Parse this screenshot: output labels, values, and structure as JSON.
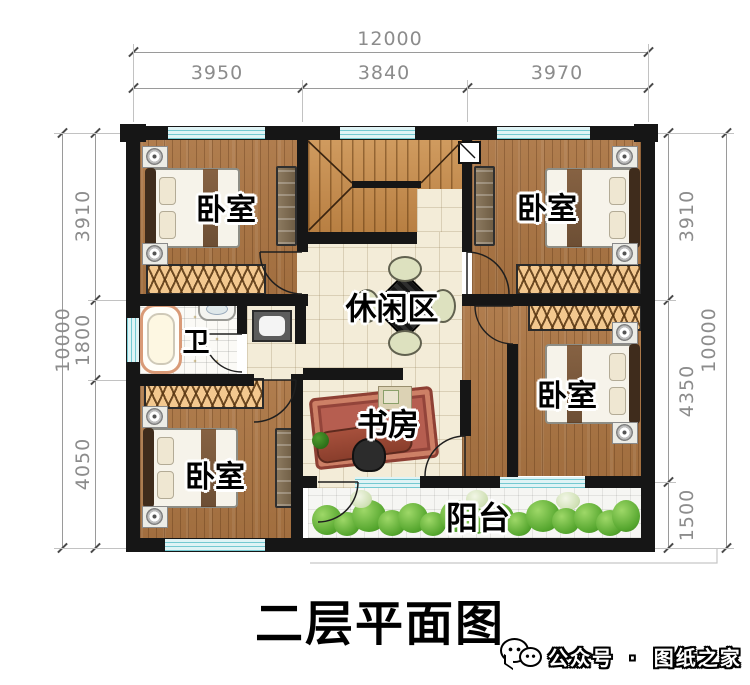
{
  "title": "二层平面图",
  "footer": {
    "account_label": "公众号",
    "separator": "·",
    "brand": "图纸之家"
  },
  "dimensions": {
    "top": {
      "total": "12000",
      "segments": [
        "3950",
        "3840",
        "3970"
      ]
    },
    "left": {
      "total": "10000",
      "segments": [
        "3910",
        "1800",
        "4050"
      ]
    },
    "right": {
      "total": "10000",
      "segments": [
        "3910",
        "4350",
        "1500"
      ]
    }
  },
  "rooms": {
    "bedroom_tl": "卧室",
    "bedroom_tr": "卧室",
    "bedroom_bl": "卧室",
    "bedroom_br": "卧室",
    "bath": "卫",
    "leisure": "休闲区",
    "study": "书房",
    "balcony": "阳台"
  },
  "colors": {
    "wall": "#161616",
    "wood_floor": "#ab7543",
    "stair_wood": "#c98f52",
    "tile_cream": "#f3ecd8",
    "window_fill": "#dff3f5",
    "window_line": "#74c9d1",
    "closet": "#f3c88f",
    "plant_green": "#55a62e",
    "dimension_gray": "#8c8c8c"
  }
}
